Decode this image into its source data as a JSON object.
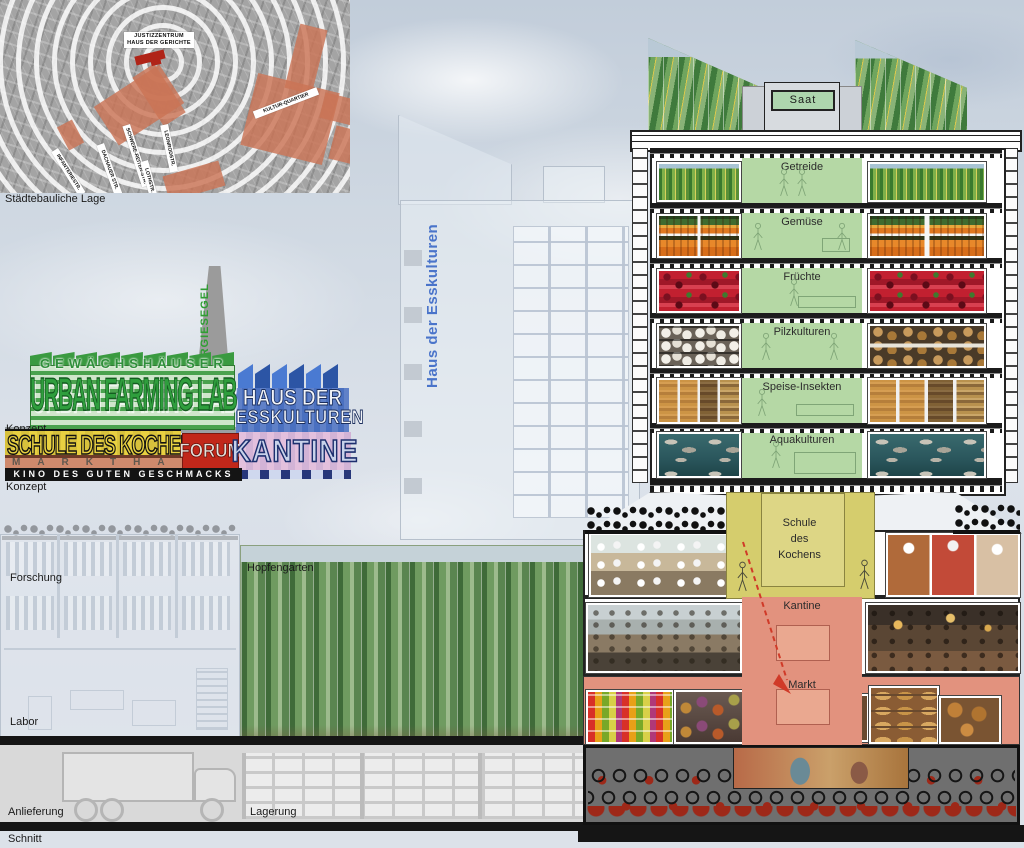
{
  "captions": {
    "site": "Städtebauliche Lage",
    "concept_top": "Konzept",
    "concept_bottom": "Konzept",
    "section": "Schnitt"
  },
  "site_map": {
    "center_label_line1": "JUSTIZZENTRUM",
    "center_label_line2": "HAUS DER GERICHTE",
    "ring_labels": [
      "KULTUR-QUARTIER",
      "DACHAUER STR.",
      "SCHWERE-REITER-STR.",
      "LEONRODSTR.",
      "INFANTERIESTR.",
      "LOTHSTR."
    ],
    "highlight_color": "#cb7456",
    "accent_color": "#b02418"
  },
  "concept": {
    "gewaechshaeuser": "GEWÄCHSHÄUSER",
    "urban_farming_lab": "URBAN FARMING LAB",
    "energiesegel": "ENERGIESEGEL",
    "haus_der": "HAUS DER",
    "esskulturen": "ESSKULTUREN",
    "schule_des_kochens": "SCHULE DES KOCHENS",
    "forum": "FORUM",
    "kantine": "KANTINE",
    "markthalle": "MARKTHALLE",
    "kino": "KINO DES GUTEN GESCHMACKS",
    "green": "#2f9e3d",
    "blue": "#4a70c0",
    "yellow": "#e8d041",
    "red": "#c1271a",
    "pink": "#dcc0dc"
  },
  "mid_tower": {
    "label": "Haus der Esskulturen",
    "label_color": "#4a74ca"
  },
  "section": {
    "saat": "Saat",
    "floors": [
      "Getreide",
      "Gemüse",
      "Früchte",
      "Pilzkulturen",
      "Speise-Insekten",
      "Aquakulturen"
    ],
    "schule_line1": "Schule",
    "schule_line2": "des",
    "schule_line3": "Kochens",
    "kantine": "Kantine",
    "markt": "Markt",
    "farm_green": "#b5d8a5",
    "schule_yellow": "#d5cd6d",
    "markt_salmon": "#e2927e"
  },
  "left_section": {
    "forschung": "Forschung",
    "hopfengarten": "Hopfengarten",
    "labor": "Labor",
    "anlieferung": "Anlieferung",
    "lagerung": "Lagerung"
  }
}
